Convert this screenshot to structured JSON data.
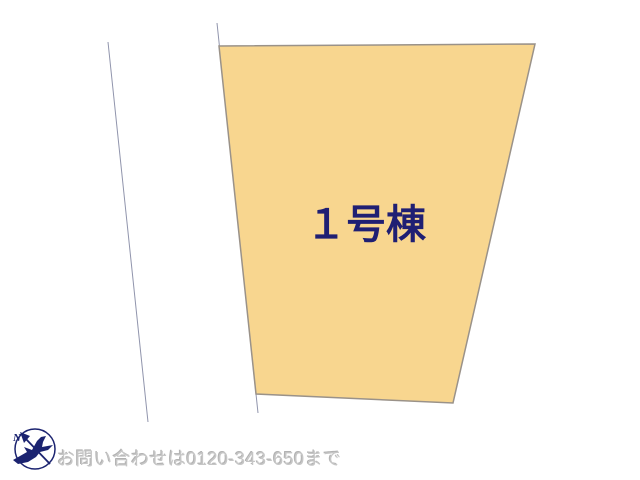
{
  "page": {
    "background_color": "#ffffff",
    "type_hint": "real-estate site plan"
  },
  "plot": {
    "label": "１号棟",
    "fill_color": "#f8d68f",
    "border_color": "#9a9289",
    "label_color": "#1f1f73"
  },
  "boundaries": {
    "line_color": "#9094ac"
  },
  "compass": {
    "north_label": "N",
    "color": "#1b2370"
  },
  "footer": {
    "contact_text": "お問い合わせは0120-343-650まで",
    "text_color": "#c6c6c6"
  }
}
